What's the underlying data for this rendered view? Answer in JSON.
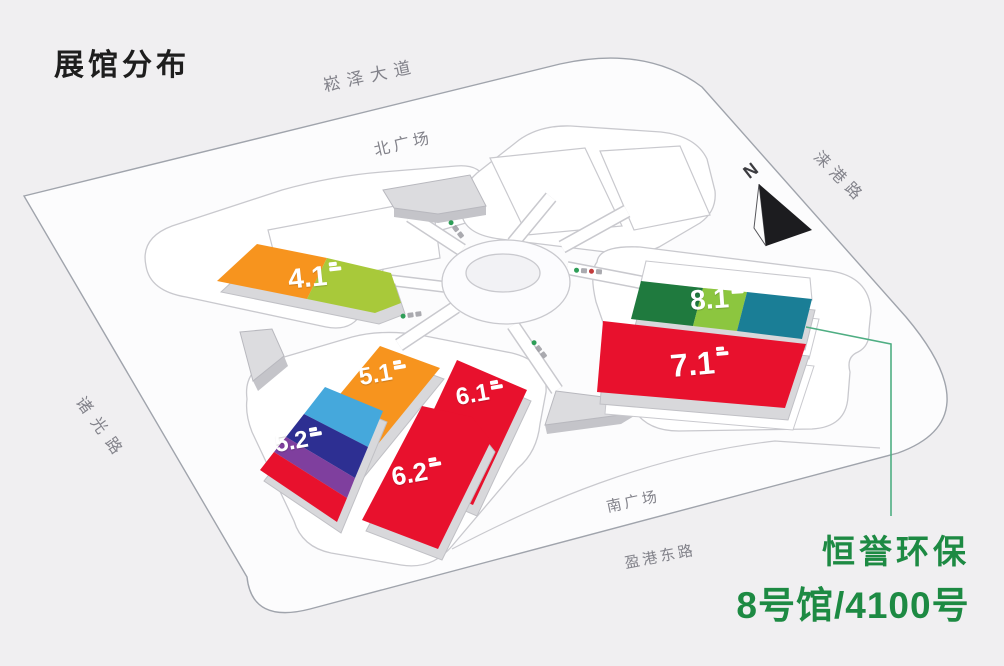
{
  "title": "展馆分布",
  "map": {
    "roads": {
      "top": "崧泽大道",
      "right": "涞港路",
      "left": "诸光路",
      "bottom": "盈港东路"
    },
    "plazas": {
      "north": "北广场",
      "south": "南广场"
    },
    "compass_label": "N"
  },
  "halls": [
    {
      "id": "hall-4-1",
      "label": "4.1",
      "colors": [
        "#F7941E",
        "#A8C93A"
      ]
    },
    {
      "id": "hall-5-1",
      "label": "5.1",
      "colors": [
        "#F7941E"
      ]
    },
    {
      "id": "hall-5-2",
      "label": "5.2",
      "colors": [
        "#45A8DC",
        "#2D2F92",
        "#7F3F9E",
        "#E8112D"
      ]
    },
    {
      "id": "hall-6-1",
      "label": "6.1",
      "colors": [
        "#E8112D"
      ]
    },
    {
      "id": "hall-6-2",
      "label": "6.2",
      "colors": [
        "#E8112D"
      ]
    },
    {
      "id": "hall-7-1",
      "label": "7.1",
      "colors": [
        "#E8112D"
      ]
    },
    {
      "id": "hall-8-1",
      "label": "8.1",
      "colors": [
        "#1F7A3E",
        "#8CC63F",
        "#1A7E96"
      ]
    }
  ],
  "annotation": {
    "exhibitor": "恒誉环保",
    "booth": "8号馆/4100号",
    "color": "#1D8A43",
    "line_color": "#4FAE83"
  }
}
